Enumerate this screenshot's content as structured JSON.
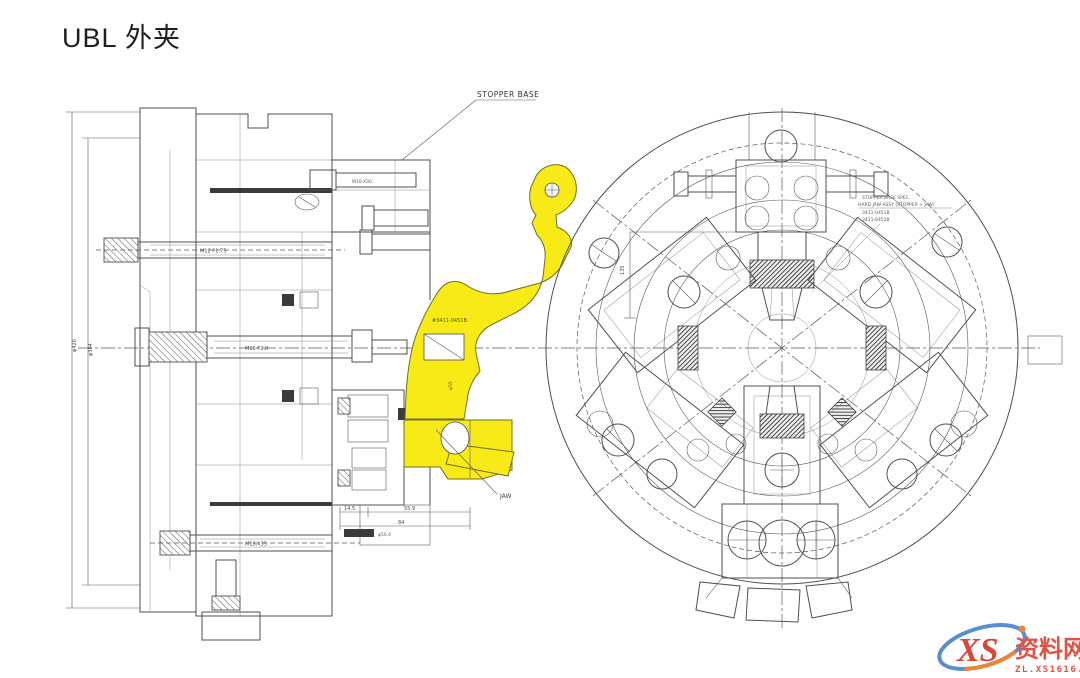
{
  "page": {
    "title": "UBL 外夹"
  },
  "colors": {
    "ink": "#4f4f4f",
    "highlight_yellow": "#f7ea16",
    "watermark_red": "#d5382a",
    "watermark_blue": "#4a86c8",
    "watermark_orange": "#e87c28"
  },
  "drawing": {
    "labels": {
      "stopper_base": "STOPPER BASE",
      "part_number": "#3411-0451B",
      "jaw": "JAW",
      "bolt_top": "M12 P1.75",
      "bolt_mid": "M16 P2.0",
      "bolt_bottom": "M16-X35",
      "bolt_stopper": "M10-X30",
      "dim_outer": "φ420",
      "dim_inner": "φ304",
      "dim_55": "φ55",
      "dim_145": "14.5",
      "dim_559": "55.9",
      "dim_84": "84",
      "dim_504": "φ50.4",
      "dim_135": "135"
    },
    "annotation": {
      "line1": "STOPPER BASE SPEC.",
      "line2": "HARD JAW ASSY (STOPPER + JAW)",
      "line3": "3411-0451B",
      "line4": "3411-0452B"
    }
  },
  "watermark": {
    "logo": "XS",
    "site_name": "资料网",
    "url": "ZL.XS1616.COM"
  }
}
